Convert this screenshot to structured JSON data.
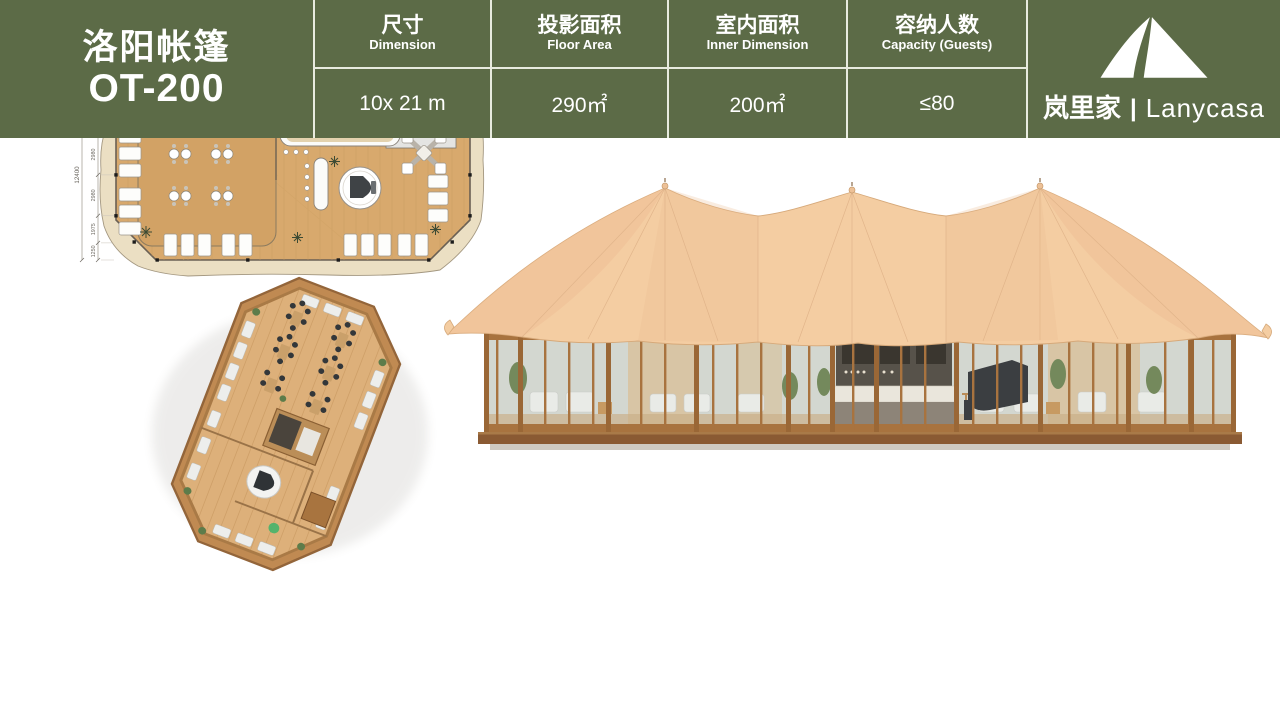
{
  "product": {
    "title_cn": "洛阳帐篷",
    "model": "OT-200"
  },
  "specs": [
    {
      "label_cn": "尺寸",
      "label_en": "Dimension",
      "value": "10x 21 m"
    },
    {
      "label_cn": "投影面积",
      "label_en": "Floor Area",
      "value": "290㎡"
    },
    {
      "label_cn": "室内面积",
      "label_en": "Inner Dimension",
      "value": "200㎡"
    },
    {
      "label_cn": "容纳人数",
      "label_en": "Capacity (Guests)",
      "value": "≤80"
    }
  ],
  "brand": {
    "cn": "岚里家",
    "sep": "|",
    "en": "Lanycasa"
  },
  "plan": {
    "total_w": "23400",
    "w": [
      "1250",
      "1475",
      "5985",
      "5985",
      "5985",
      "1475",
      "1250"
    ],
    "total_d": "12400",
    "d": [
      "1250",
      "1965",
      "2980",
      "2980",
      "1975",
      "1250"
    ]
  },
  "colors": {
    "bar_green": "#5c6b47",
    "grid_line": "#e8ebdf",
    "tent_canvas": "#f4cda2",
    "tent_shade": "#eec096",
    "wood_frame": "#a8733f",
    "plan_floor": "#d8a96d",
    "plan_canvas": "#ebdfc3",
    "text_white": "#ffffff"
  }
}
